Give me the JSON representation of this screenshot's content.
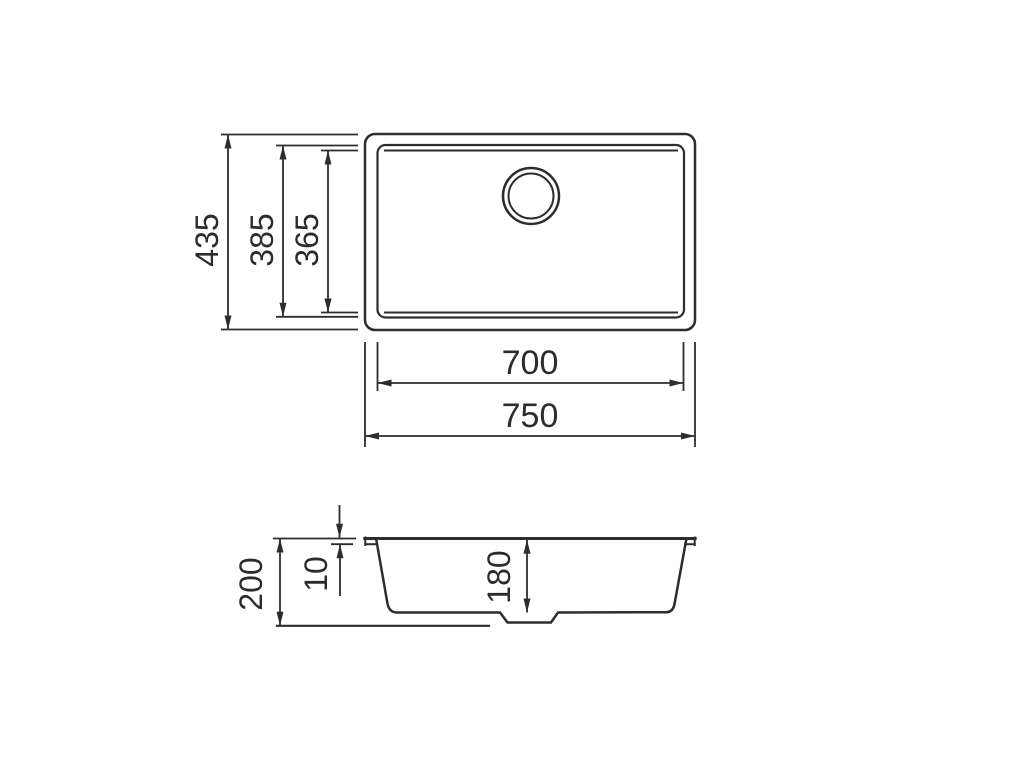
{
  "drawing": {
    "kind": "sink-technical-drawing",
    "colors": {
      "line": "#2d2d2d",
      "background": "#ffffff"
    },
    "top_view": {
      "dims": {
        "overall_height": "435",
        "inner_height": "385",
        "bowl_height": "365",
        "bowl_width": "700",
        "overall_width": "750"
      }
    },
    "side_view": {
      "dims": {
        "total_depth": "200",
        "rim_thickness": "10",
        "bowl_depth": "180"
      }
    }
  }
}
